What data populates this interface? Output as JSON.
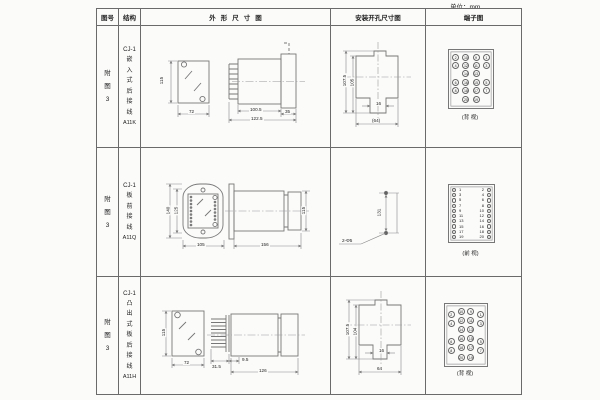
{
  "unit": "单位：mm",
  "header": {
    "fig_no": "图号",
    "structure": "结构",
    "outline": "外形尺寸图",
    "mounting": "安装开孔尺寸图",
    "terminal": "端子图"
  },
  "rows": [
    {
      "fig_no": "附\n图\n3",
      "model": "CJ-1",
      "structure": "嵌\n入\n式\n后\n接\n线",
      "code": "A11K",
      "outline": {
        "height": "115",
        "width": "72",
        "body_length": "100.5",
        "overall_length": "122.5",
        "rear_length": "35"
      },
      "mounting": {
        "outer_height": "107.5",
        "inner_height": "105",
        "notch_width": "16",
        "cutout_width": "(64)"
      },
      "terminal": {
        "caption": "(背 视)",
        "grid": [
          [
            "2",
            "10",
            "9",
            "1"
          ],
          [
            "4",
            "12",
            "11",
            "3"
          ],
          [
            "",
            "14",
            "13",
            ""
          ],
          [
            "6",
            "16",
            "15",
            "5"
          ],
          [
            "8",
            "18",
            "17",
            "7"
          ],
          [
            "",
            "20",
            "19",
            ""
          ]
        ]
      }
    },
    {
      "fig_no": "附\n图\n3",
      "model": "CJ-1",
      "structure": "板\n前\n接\n线",
      "code": "A11Q",
      "outline": {
        "height": "140",
        "hole_spacing": "125",
        "width": "105",
        "length": "156",
        "side_height": "115"
      },
      "mounting": {
        "hole_spacing": "131",
        "holes": "2-Φ5"
      },
      "terminal": {
        "caption": "(前 视)",
        "left": [
          "1",
          "3",
          "5",
          "7",
          "9",
          "11",
          "13",
          "15",
          "17",
          "19"
        ],
        "right": [
          "2",
          "4",
          "6",
          "8",
          "10",
          "12",
          "14",
          "16",
          "18",
          "20"
        ]
      }
    },
    {
      "fig_no": "附\n图\n3",
      "model": "CJ-1",
      "structure": "凸\n出\n式\n板\n后\n接\n线",
      "code": "A11H",
      "outline": {
        "height": "115",
        "width": "72",
        "comb_depth": "31.5",
        "stub": "9.5",
        "length": "126"
      },
      "mounting": {
        "outer_height": "107.5",
        "inner_height": "104",
        "notch_width": "16",
        "cutout_width": "64"
      },
      "terminal": {
        "caption": "(背 视)",
        "grid": [
          [
            "2",
            "10",
            "9",
            "1"
          ],
          [
            "4",
            "12",
            "11",
            "3"
          ],
          [
            "",
            "14",
            "13",
            ""
          ],
          [
            "6",
            "16",
            "15",
            "5"
          ],
          [
            "8",
            "18",
            "17",
            "7"
          ],
          [
            "",
            "20",
            "19",
            ""
          ]
        ]
      }
    }
  ]
}
